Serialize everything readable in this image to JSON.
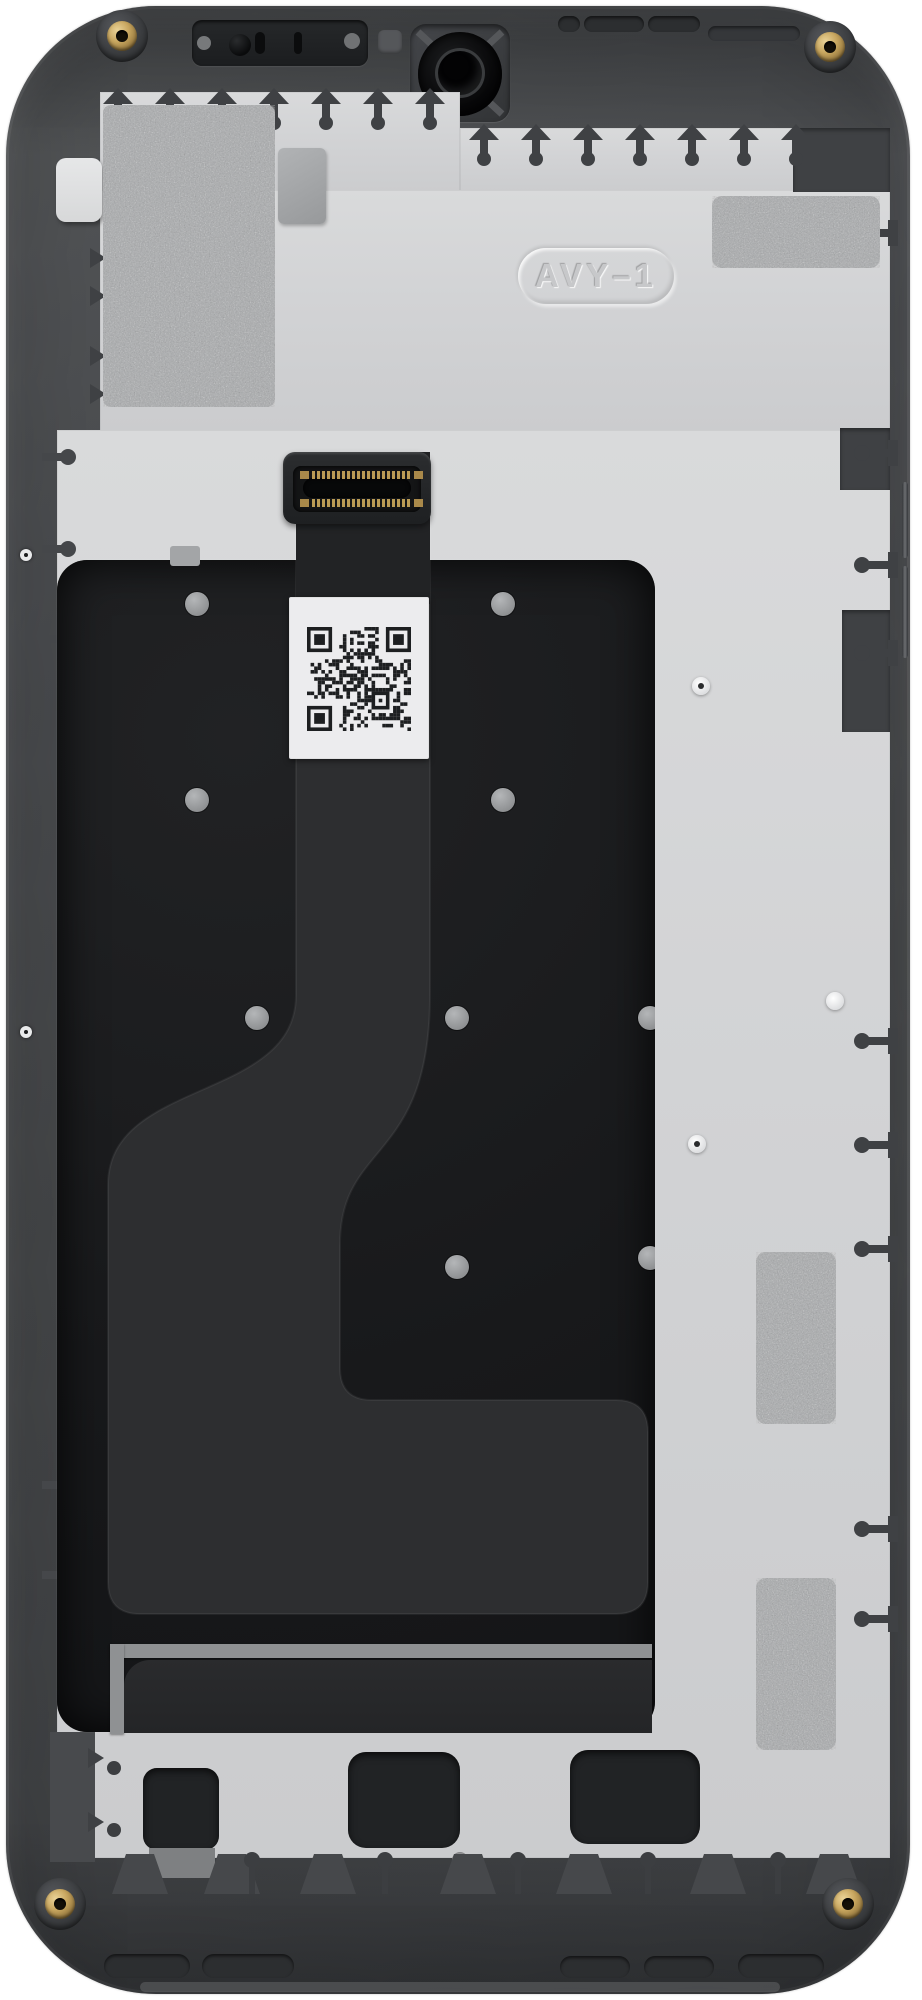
{
  "meta": {
    "subject": "Smartphone mid-frame with display assembly, rear interior view",
    "orientation": "portrait"
  },
  "markings": {
    "stamp_label": "AVY–1",
    "qr_code": "unreadable-2d-barcode"
  },
  "colors": {
    "background": "#ffffff",
    "frame_gray": "#484a4d",
    "frame_dark": "#3f4144",
    "backplate": "#d2d3d5",
    "display_panel": "#1a1b1d",
    "flex_cable": "#2d2e30",
    "qr_label": "#ececee",
    "thermal_pad": "#b2b4b6",
    "screw_gold": "#c3a25d",
    "metal_strip": "#8f9193",
    "earpiece_black": "#202224"
  }
}
